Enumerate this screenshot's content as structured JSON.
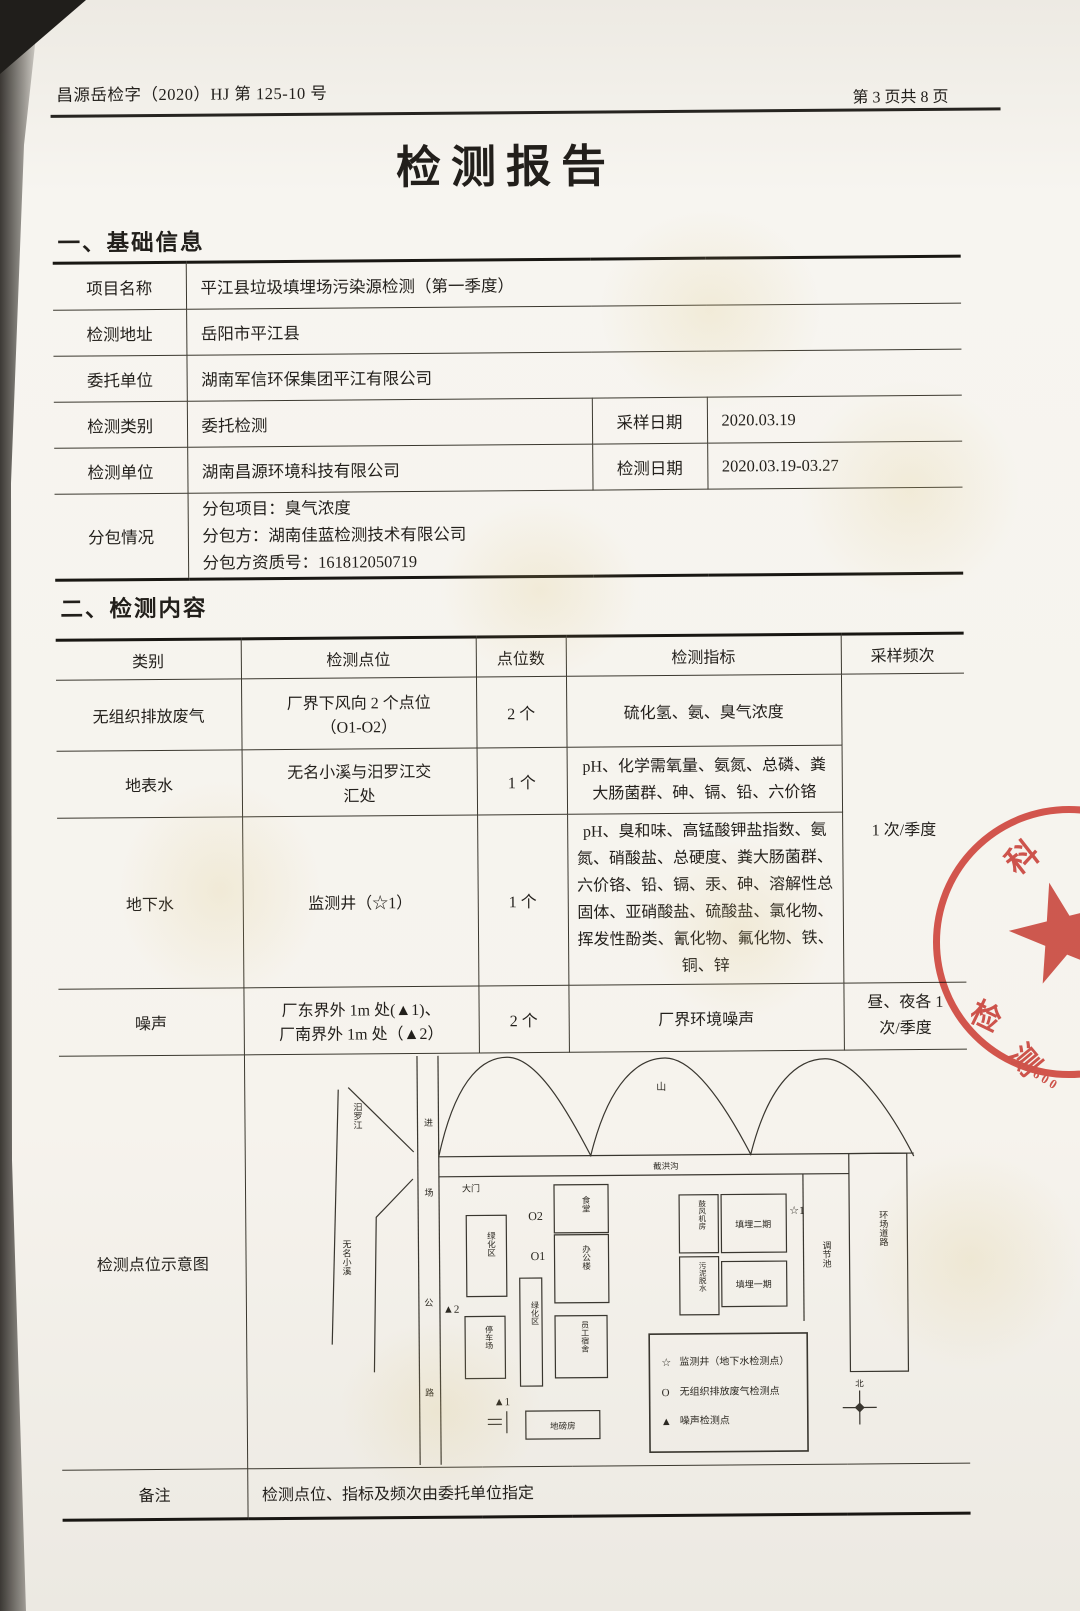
{
  "header": {
    "doc_no": "昌源岳检字（2020）HJ 第 125-10 号",
    "page_no": "第 3 页共 8 页"
  },
  "title": "检测报告",
  "basic_info": {
    "heading": "一、基础信息",
    "rows": {
      "project": {
        "label": "项目名称",
        "value": "平江县垃圾填埋场污染源检测（第一季度）"
      },
      "address": {
        "label": "检测地址",
        "value": "岳阳市平江县"
      },
      "client": {
        "label": "委托单位",
        "value": "湖南军信环保集团平江有限公司"
      },
      "type": {
        "label": "检测类别",
        "value": "委托检测"
      },
      "sampling": {
        "label": "采样日期",
        "value": "2020.03.19"
      },
      "agency": {
        "label": "检测单位",
        "value": "湖南昌源环境科技有限公司"
      },
      "testing": {
        "label": "检测日期",
        "value": "2020.03.19-03.27"
      },
      "subcontract": {
        "label": "分包情况",
        "line1": "分包项目：臭气浓度",
        "line2": "分包方：湖南佳蓝检测技术有限公司",
        "line3": "分包方资质号：161812050719"
      }
    }
  },
  "content": {
    "heading": "二、检测内容",
    "columns": [
      "类别",
      "检测点位",
      "点位数",
      "检测指标",
      "采样频次"
    ],
    "freq_merged": "1 次/季度",
    "rows": [
      {
        "category": "无组织排放废气",
        "points": "厂界下风向 2 个点位\n（O1-O2）",
        "count": "2 个",
        "indicators": "硫化氢、氨、臭气浓度"
      },
      {
        "category": "地表水",
        "points": "无名小溪与汨罗江交\n汇处",
        "count": "1 个",
        "indicators": "pH、化学需氧量、氨氮、总磷、粪大肠菌群、砷、镉、铅、六价铬"
      },
      {
        "category": "地下水",
        "points": "监测井（☆1）",
        "count": "1 个",
        "indicators": "pH、臭和味、高锰酸钾盐指数、氨氮、硝酸盐、总硬度、粪大肠菌群、六价铬、铅、镉、汞、砷、溶解性总固体、亚硝酸盐、硫酸盐、氯化物、挥发性酚类、氰化物、氟化物、铁、铜、锌"
      },
      {
        "category": "噪声",
        "points": "厂东界外 1m 处(▲1)、\n厂南界外 1m 处（▲2）",
        "count": "2 个",
        "indicators": "厂界环境噪声",
        "frequency": "昼、夜各 1\n次/季度"
      }
    ],
    "diagram_row_label": "检测点位示意图",
    "remark": {
      "label": "备注",
      "value": "检测点位、指标及频次由委托单位指定"
    }
  },
  "diagram": {
    "mountain": "山",
    "channel": "截洪沟",
    "river": "汨罗江",
    "creek": "无名小溪",
    "road_chars": [
      "进",
      "场",
      "公",
      "路"
    ],
    "gate": "大门",
    "buildings": {
      "green1": "绿化区",
      "canteen": "食堂",
      "office": "办公楼",
      "green2": "绿化区",
      "parking": "停车场",
      "dorm": "员工宿舍",
      "weighbridge": "地磅房",
      "blower": "鼓风机房",
      "sludge": "污泥脱水",
      "landfill2": "填埋二期",
      "landfill1": "填埋一期",
      "pond": "调节池",
      "ring_road": "环场道路"
    },
    "markers": {
      "o2": "O2",
      "o1": "O1",
      "noise2": "▲2",
      "noise1": "▲1",
      "well": "☆1"
    },
    "legend": [
      {
        "symbol": "☆",
        "label": "监测井（地下水检测点）"
      },
      {
        "symbol": "O",
        "label": "无组织排放废气检测点"
      },
      {
        "symbol": "▲",
        "label": "噪声检测点"
      }
    ],
    "compass": "北"
  },
  "stamp": {
    "char1": "科",
    "char2": "检",
    "char3": "测",
    "digits": "600"
  }
}
